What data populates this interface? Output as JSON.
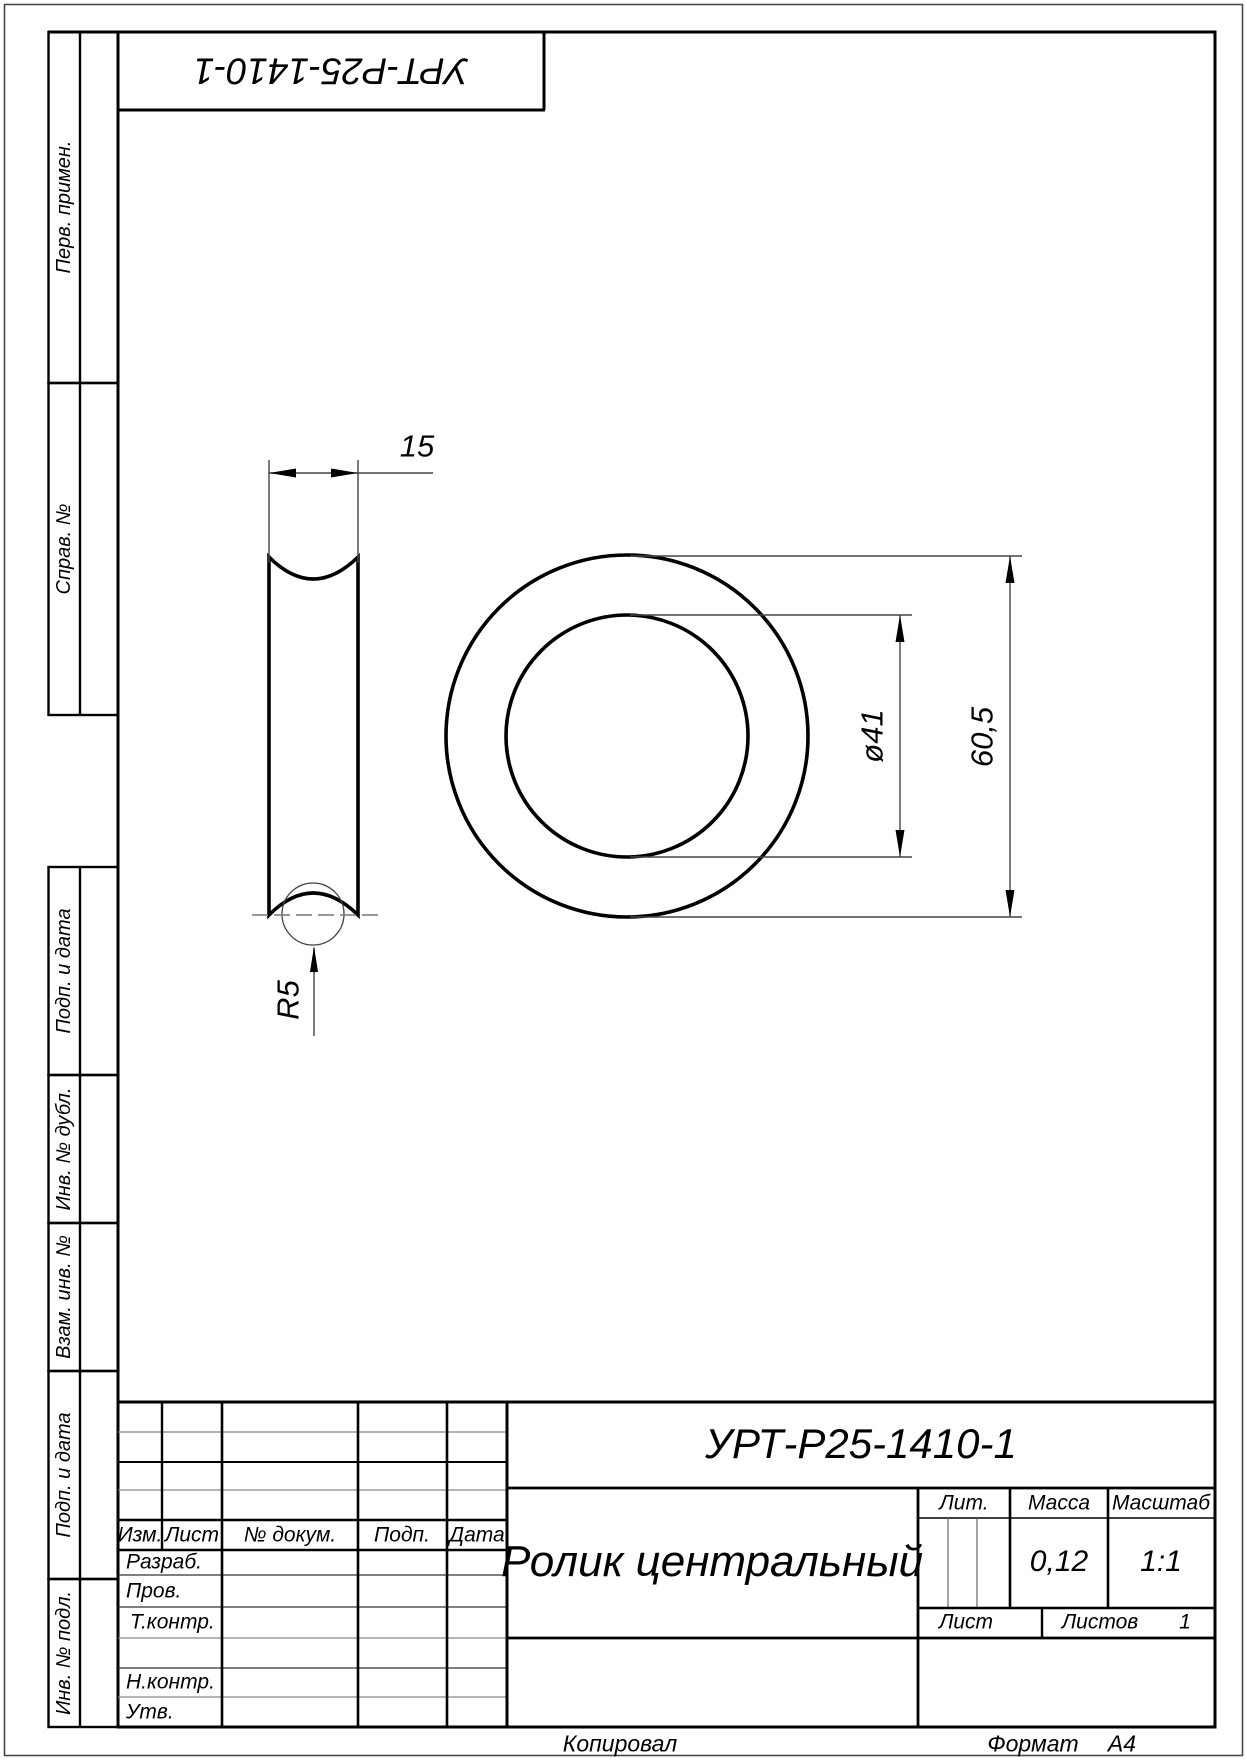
{
  "sheet": {
    "designation": "УРТ-Р25-1410-1",
    "designation_top": "УРТ-Р25-1410-1",
    "part_name": "Ролик центральный",
    "copied_label": "Копировал",
    "format_label": "Формат",
    "format_value": "А4",
    "line_color": "#000000",
    "thin_line_color": "#555555"
  },
  "side_margin": {
    "labels": [
      "Перв. примен.",
      "Справ. №",
      "Подп. и дата",
      "Инв. № дубл.",
      "Взам. инв. №",
      "Подп. и дата",
      "Инв. № подл."
    ]
  },
  "dimensions": {
    "width": "15",
    "bore_diameter": "ø41",
    "outer_diameter": "60,5",
    "groove_radius": "R5"
  },
  "title_block": {
    "header": {
      "izm": "Изм.",
      "list": "Лист",
      "doc": "№ докум.",
      "podp": "Подп.",
      "data": "Дата"
    },
    "rows": {
      "razrab": "Разраб.",
      "prov": "Пров.",
      "tkontr": "Т.контр.",
      "nkontr": "Н.контр.",
      "utv": "Утв."
    },
    "lit_label": "Лит.",
    "massa_label": "Масса",
    "masshtab_label": "Масштаб",
    "massa_value": "0,12",
    "masshtab_value": "1:1",
    "list_label": "Лист",
    "listov_label": "Листов",
    "listov_value": "1"
  }
}
